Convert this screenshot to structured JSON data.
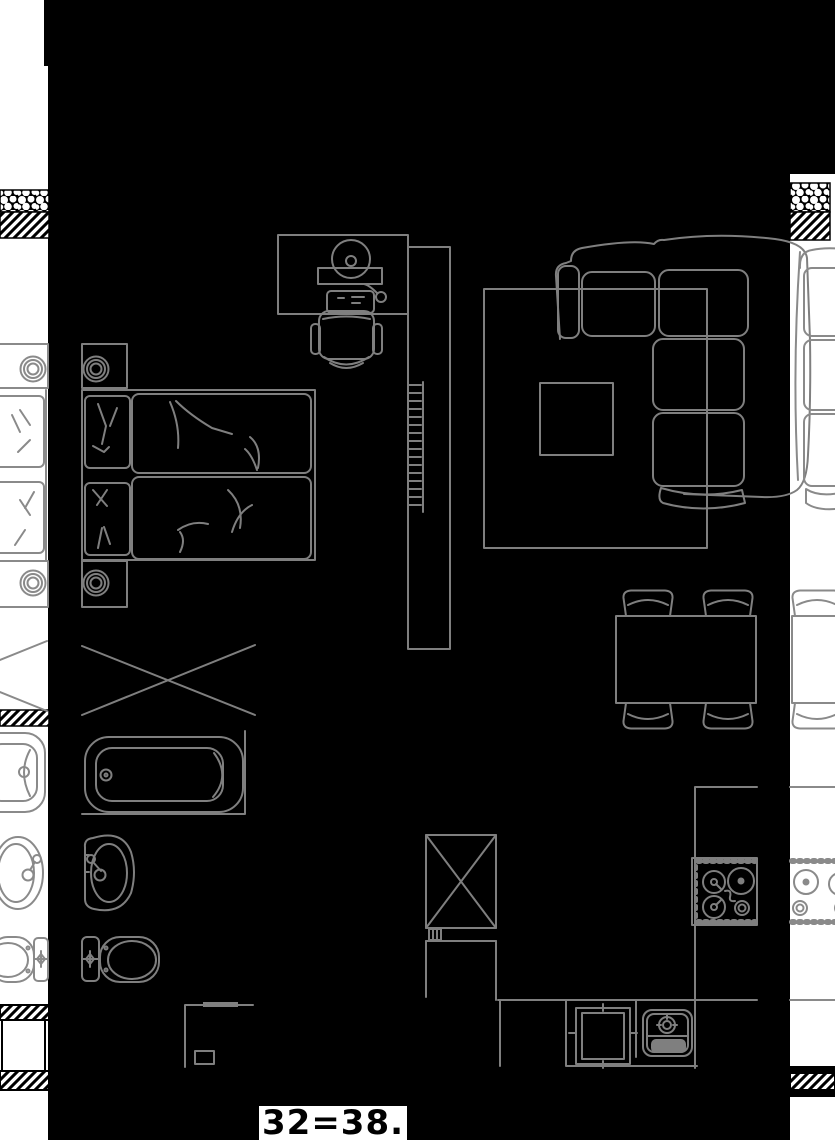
{
  "drawing": {
    "type": "apartment-floor-plan-dark",
    "dimension_label": "32=38.",
    "colors": {
      "background": "#000000",
      "line": "#7f7f7f",
      "wall_strip": "#ffffff",
      "hatch": "#000000",
      "label_text": "#000000",
      "label_bg": "#ffffff"
    },
    "symbols": [
      "double-bed",
      "pillow",
      "duvet",
      "nightstand-lamp",
      "wardrobe-x-symbol",
      "desk",
      "monitor",
      "keyboard",
      "mouse",
      "office-chair",
      "radiator-cabinet",
      "rug",
      "coffee-table",
      "corner-sofa",
      "dining-table",
      "dining-chair",
      "bathtub",
      "washbasin",
      "toilet",
      "refrigerator-x-symbol",
      "dishwasher",
      "kitchen-sink",
      "cooktop",
      "wall-section-hatch",
      "adjacent-unit-left",
      "adjacent-unit-right"
    ]
  }
}
